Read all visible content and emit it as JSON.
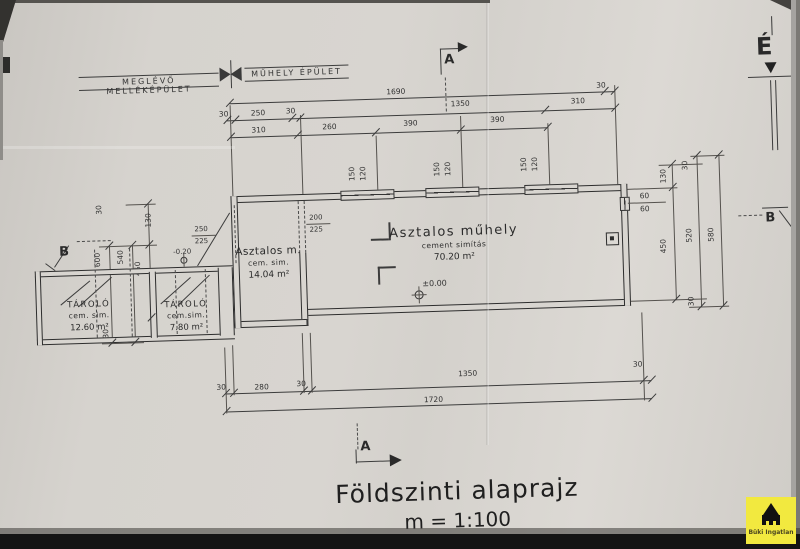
{
  "drawing": {
    "header": {
      "left_building": "MEGLÉVŐ MELLÉKÉPÜLET",
      "right_building": "MŰHELY ÉPÜLET"
    },
    "title": {
      "main": "Földszinti alaprajz",
      "scale": "m = 1:100"
    },
    "section_markers": {
      "top": "A",
      "bottom": "A",
      "left": "B",
      "right": "B",
      "north": "É"
    },
    "rooms": {
      "storage1": {
        "name": "TÁROLÓ",
        "finish": "cem. sim.",
        "area": "12.60 m²"
      },
      "storage2": {
        "name": "TÁROLÓ",
        "finish": "cem.sim.",
        "area": "7.80 m²"
      },
      "carpenter_room": {
        "name": "Asztalos m.",
        "finish": "cem. sim.",
        "area": "14.04 m²"
      },
      "workshop": {
        "name": "Asztalos műhely",
        "finish": "cement simítás",
        "area": "70.20 m²"
      }
    },
    "levels": {
      "workshop": "±0.00",
      "storage": "-0.20"
    },
    "dims": {
      "top1_total": "1690",
      "top1_end": "30",
      "top2": [
        "30",
        "250",
        "30",
        "1350",
        "310"
      ],
      "top3": [
        "310",
        "260",
        "390",
        "390"
      ],
      "bottom1": [
        "30",
        "280",
        "30",
        "1350",
        "30"
      ],
      "bottom2_total": "1720",
      "left": [
        "30",
        "130",
        "540",
        "450",
        "600",
        "30"
      ],
      "right": [
        "130",
        "30",
        "450",
        "520",
        "580",
        "30"
      ],
      "window_top_w": "150",
      "window_top_h": "120",
      "window_right_a": "60",
      "window_right_b": "60",
      "door_main_w": "200",
      "door_main_h": "225",
      "door_left_w": "250",
      "door_left_h": "225"
    },
    "logo": {
      "line1": "Büki Ingatlan"
    }
  }
}
